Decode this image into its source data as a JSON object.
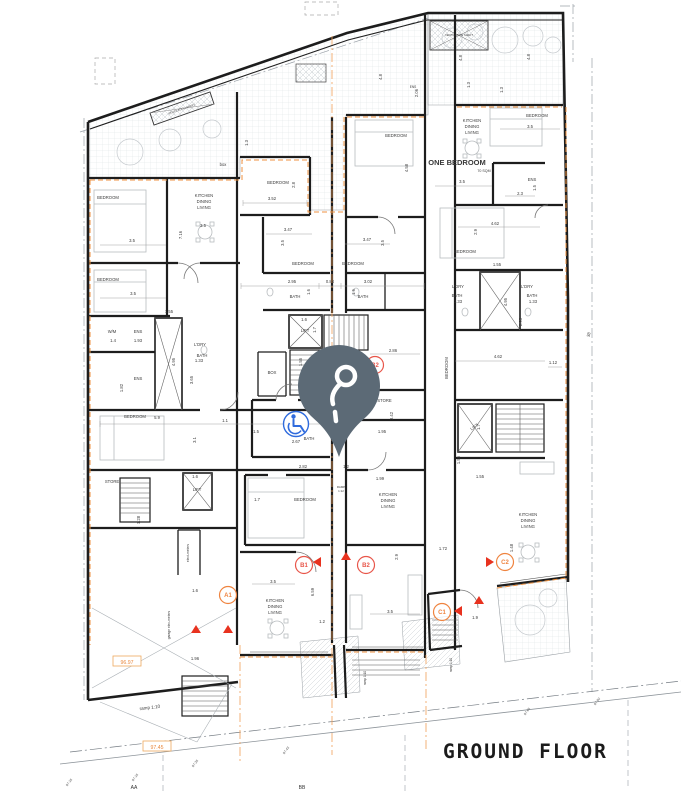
{
  "title": "GROUND FLOOR",
  "colors": {
    "wall": "#1d1d1d",
    "boundary_orange": "#ef9240",
    "marker_red": "#e8564a",
    "marker_orange": "#ef8440",
    "pin": "#5c6a76",
    "accessible_blue": "#2f6bdd",
    "level_orange": "#e8873c",
    "hatch_grey": "#d8dcdf"
  },
  "icons": {
    "pin": "location-pin",
    "accessibility": "wheelchair-symbol"
  },
  "plan": {
    "labels": [
      {
        "n": "room-label",
        "t": "BEDROOM",
        "x": 108,
        "y": 199
      },
      {
        "n": "room-label",
        "t": "BEDROOM",
        "x": 108,
        "y": 281
      },
      {
        "n": "room-label",
        "t": "BEDROOM",
        "x": 278,
        "y": 184
      },
      {
        "n": "room-label",
        "t": "BEDROOM",
        "x": 303,
        "y": 265
      },
      {
        "n": "room-label",
        "t": "BEDROOM",
        "x": 353,
        "y": 265
      },
      {
        "n": "room-label",
        "t": "BEDROOM",
        "x": 396,
        "y": 137
      },
      {
        "n": "room-label",
        "t": "BEDROOM",
        "x": 537,
        "y": 117
      },
      {
        "n": "room-label",
        "t": "BEDROOM",
        "x": 465,
        "y": 253
      },
      {
        "n": "room-label",
        "t": "BEDROOM",
        "x": 135,
        "y": 418
      },
      {
        "n": "room-label",
        "t": "BEDROOM",
        "x": 305,
        "y": 501
      },
      {
        "n": "room-label",
        "t": "BEDROOM",
        "x": 448,
        "y": 368,
        "r": -90
      },
      {
        "n": "room-label",
        "t": "KITCHEN",
        "x": 204,
        "y": 197
      },
      {
        "n": "room-label",
        "t": "DINING",
        "x": 204,
        "y": 203
      },
      {
        "n": "room-label",
        "t": "LIVING",
        "x": 204,
        "y": 209
      },
      {
        "n": "room-label",
        "t": "KITCHEN",
        "x": 472,
        "y": 122
      },
      {
        "n": "room-label",
        "t": "DINING",
        "x": 472,
        "y": 128
      },
      {
        "n": "room-label",
        "t": "LIVING",
        "x": 472,
        "y": 134
      },
      {
        "n": "room-label",
        "t": "KITCHEN",
        "x": 388,
        "y": 496
      },
      {
        "n": "room-label",
        "t": "DINING",
        "x": 388,
        "y": 502
      },
      {
        "n": "room-label",
        "t": "LIVING",
        "x": 388,
        "y": 508
      },
      {
        "n": "room-label",
        "t": "KITCHEN",
        "x": 275,
        "y": 602
      },
      {
        "n": "room-label",
        "t": "DINING",
        "x": 275,
        "y": 608
      },
      {
        "n": "room-label",
        "t": "LIVING",
        "x": 275,
        "y": 614
      },
      {
        "n": "room-label",
        "t": "KITCHEN",
        "x": 528,
        "y": 516
      },
      {
        "n": "room-label",
        "t": "DINING",
        "x": 528,
        "y": 522
      },
      {
        "n": "room-label",
        "t": "LIVING",
        "x": 528,
        "y": 528
      },
      {
        "n": "unit-type-label",
        "t": "ONE BEDROOM",
        "x": 457,
        "y": 165,
        "s": 7.5,
        "b": 1
      },
      {
        "n": "area-label",
        "t": "70 SQM",
        "x": 484,
        "y": 172,
        "s": 3.6
      },
      {
        "n": "room-label",
        "t": "BATH",
        "x": 295,
        "y": 298
      },
      {
        "n": "room-label",
        "t": "BATH",
        "x": 363,
        "y": 298
      },
      {
        "n": "room-label",
        "t": "BATH",
        "x": 202,
        "y": 357
      },
      {
        "n": "room-label",
        "t": "BATH",
        "x": 309,
        "y": 440
      },
      {
        "n": "room-label",
        "t": "BATH",
        "x": 457,
        "y": 297
      },
      {
        "n": "room-label",
        "t": "BATH",
        "x": 532,
        "y": 297
      },
      {
        "n": "room-label",
        "t": "L'DRY",
        "x": 200,
        "y": 346
      },
      {
        "n": "room-label",
        "t": "L'DRY",
        "x": 458,
        "y": 288
      },
      {
        "n": "room-label",
        "t": "L'DRY",
        "x": 527,
        "y": 288
      },
      {
        "n": "room-label",
        "t": "L'DRY/STORE",
        "x": 378,
        "y": 402
      },
      {
        "n": "room-label",
        "t": "ENS",
        "x": 532,
        "y": 181
      },
      {
        "n": "room-label",
        "t": "ENS",
        "x": 413,
        "y": 88,
        "s": 3.2
      },
      {
        "n": "room-label",
        "t": "ENS",
        "x": 138,
        "y": 333
      },
      {
        "n": "room-label",
        "t": "ENS",
        "x": 138,
        "y": 380
      },
      {
        "n": "room-label",
        "t": "W/M",
        "x": 112,
        "y": 333
      },
      {
        "n": "room-label",
        "t": "STORE",
        "x": 112,
        "y": 483
      },
      {
        "n": "room-label",
        "t": "BOX",
        "x": 272,
        "y": 374
      },
      {
        "n": "room-label",
        "t": "box",
        "x": 223,
        "y": 166
      },
      {
        "n": "room-label",
        "t": "LIFT",
        "x": 305,
        "y": 332
      },
      {
        "n": "room-label",
        "t": "LIFT",
        "x": 197,
        "y": 491
      },
      {
        "n": "room-label",
        "t": "LIFT",
        "x": 475,
        "y": 428,
        "r": -35
      },
      {
        "n": "shaft-label",
        "t": "VENTILATION SHAFT",
        "x": 182,
        "y": 110,
        "s": 2.8,
        "r": -19
      },
      {
        "n": "shaft-label",
        "t": "VENTILATION SHAFT",
        "x": 459,
        "y": 36,
        "s": 2.8
      },
      {
        "n": "note-label",
        "t": "ramp 1:10",
        "x": 150,
        "y": 709,
        "s": 4.6,
        "r": -7
      },
      {
        "n": "note-label",
        "t": "RAMP",
        "x": 341,
        "y": 488,
        "s": 2.9
      },
      {
        "n": "note-label",
        "t": "1:12",
        "x": 341,
        "y": 492,
        "s": 2.9
      },
      {
        "n": "note-label",
        "t": "ramp 1:10",
        "x": 366,
        "y": 678,
        "s": 3.2,
        "r": -90
      },
      {
        "n": "note-label",
        "t": "ramp 1:10",
        "x": 452,
        "y": 665,
        "s": 3.2,
        "r": -90
      },
      {
        "n": "note-label",
        "t": "elect-meters",
        "x": 189,
        "y": 553,
        "s": 3.3,
        "r": -90
      },
      {
        "n": "note-label",
        "t": "garage elec-meters",
        "x": 170,
        "y": 625,
        "s": 3.3,
        "r": -90
      },
      {
        "n": "dim-label",
        "t": "3.52",
        "x": 272,
        "y": 200
      },
      {
        "n": "dim-label",
        "t": "3.47",
        "x": 288,
        "y": 231
      },
      {
        "n": "dim-label",
        "t": "3.47",
        "x": 367,
        "y": 241
      },
      {
        "n": "dim-label",
        "t": "3.5",
        "x": 284,
        "y": 243,
        "r": -90
      },
      {
        "n": "dim-label",
        "t": "3.5",
        "x": 384,
        "y": 243,
        "r": -90
      },
      {
        "n": "dim-label",
        "t": "2.8",
        "x": 295,
        "y": 185,
        "r": -90
      },
      {
        "n": "dim-label",
        "t": "4.58",
        "x": 408,
        "y": 168,
        "r": -90
      },
      {
        "n": "dim-label",
        "t": "1.3",
        "x": 248,
        "y": 143,
        "r": -90
      },
      {
        "n": "dim-label",
        "t": "4.8",
        "x": 382,
        "y": 77,
        "r": -90
      },
      {
        "n": "dim-label",
        "t": "4.8",
        "x": 462,
        "y": 58,
        "r": -90
      },
      {
        "n": "dim-label",
        "t": "4.8",
        "x": 530,
        "y": 57,
        "r": -90
      },
      {
        "n": "dim-label",
        "t": "2.06",
        "x": 418,
        "y": 93,
        "r": -90
      },
      {
        "n": "dim-label",
        "t": "1.3",
        "x": 470,
        "y": 85,
        "r": -90
      },
      {
        "n": "dim-label",
        "t": "1.3",
        "x": 503,
        "y": 90,
        "r": -90
      },
      {
        "n": "dim-label",
        "t": "3.5",
        "x": 132,
        "y": 242
      },
      {
        "n": "dim-label",
        "t": "3.5",
        "x": 133,
        "y": 295
      },
      {
        "n": "dim-label",
        "t": "3.5",
        "x": 203,
        "y": 227
      },
      {
        "n": "dim-label",
        "t": "7.16",
        "x": 182,
        "y": 235,
        "r": -90
      },
      {
        "n": "dim-label",
        "t": "2.95",
        "x": 292,
        "y": 283
      },
      {
        "n": "dim-label",
        "t": "0.84",
        "x": 330,
        "y": 283
      },
      {
        "n": "dim-label",
        "t": "3.02",
        "x": 368,
        "y": 283
      },
      {
        "n": "dim-label",
        "t": "1.6",
        "x": 310,
        "y": 292,
        "r": -90
      },
      {
        "n": "dim-label",
        "t": "1.6",
        "x": 355,
        "y": 292,
        "r": -90
      },
      {
        "n": "dim-label",
        "t": "1.6",
        "x": 304,
        "y": 321
      },
      {
        "n": "dim-label",
        "t": "1.7",
        "x": 316,
        "y": 330,
        "r": -90
      },
      {
        "n": "dim-label",
        "t": "2.86",
        "x": 393,
        "y": 352
      },
      {
        "n": "dim-label",
        "t": "1.55",
        "x": 302,
        "y": 362,
        "r": -90
      },
      {
        "n": "dim-label",
        "t": "3.5",
        "x": 462,
        "y": 183
      },
      {
        "n": "dim-label",
        "t": "3.5",
        "x": 530,
        "y": 128
      },
      {
        "n": "dim-label",
        "t": "2.3",
        "x": 520,
        "y": 195
      },
      {
        "n": "dim-label",
        "t": "1.5",
        "x": 536,
        "y": 188,
        "r": -90
      },
      {
        "n": "dim-label",
        "t": "4.62",
        "x": 495,
        "y": 225
      },
      {
        "n": "dim-label",
        "t": "2.9",
        "x": 477,
        "y": 232,
        "r": -90
      },
      {
        "n": "dim-label",
        "t": "1.55",
        "x": 497,
        "y": 266
      },
      {
        "n": "dim-label",
        "t": "4.95",
        "x": 507,
        "y": 302,
        "r": -90
      },
      {
        "n": "dim-label",
        "t": "1.33",
        "x": 458,
        "y": 303
      },
      {
        "n": "dim-label",
        "t": "1.33",
        "x": 533,
        "y": 303
      },
      {
        "n": "dim-label",
        "t": "2.95",
        "x": 522,
        "y": 322,
        "r": -90
      },
      {
        "n": "dim-label",
        "t": "4.62",
        "x": 498,
        "y": 358
      },
      {
        "n": "dim-label",
        "t": "1.12",
        "x": 553,
        "y": 364
      },
      {
        "n": "dim-label",
        "t": "38",
        "x": 590,
        "y": 335,
        "r": -75
      },
      {
        "n": "dim-label",
        "t": "1.55",
        "x": 169,
        "y": 313
      },
      {
        "n": "dim-label",
        "t": "4.95",
        "x": 175,
        "y": 362,
        "r": -90
      },
      {
        "n": "dim-label",
        "t": "1.4",
        "x": 113,
        "y": 342
      },
      {
        "n": "dim-label",
        "t": "1.93",
        "x": 138,
        "y": 342
      },
      {
        "n": "dim-label",
        "t": "1.82",
        "x": 123,
        "y": 388,
        "r": -90
      },
      {
        "n": "dim-label",
        "t": "3.65",
        "x": 193,
        "y": 380,
        "r": -90
      },
      {
        "n": "dim-label",
        "t": "1.33",
        "x": 199,
        "y": 362
      },
      {
        "n": "dim-label",
        "t": "5.9",
        "x": 157,
        "y": 419
      },
      {
        "n": "dim-label",
        "t": "1.1",
        "x": 225,
        "y": 422
      },
      {
        "n": "dim-label",
        "t": "3.1",
        "x": 196,
        "y": 440,
        "r": -90
      },
      {
        "n": "dim-label",
        "t": "2.67",
        "x": 296,
        "y": 443
      },
      {
        "n": "dim-label",
        "t": "1.5",
        "x": 256,
        "y": 433
      },
      {
        "n": "dim-label",
        "t": "2.82",
        "x": 303,
        "y": 468
      },
      {
        "n": "dim-label",
        "t": "1.2",
        "x": 346,
        "y": 468
      },
      {
        "n": "dim-label",
        "t": "1.7",
        "x": 257,
        "y": 501
      },
      {
        "n": "dim-label",
        "t": "3.5",
        "x": 273,
        "y": 583
      },
      {
        "n": "dim-label",
        "t": "6.59",
        "x": 314,
        "y": 592,
        "r": -90
      },
      {
        "n": "dim-label",
        "t": "1.2",
        "x": 322,
        "y": 623
      },
      {
        "n": "dim-label",
        "t": "1.95",
        "x": 382,
        "y": 433
      },
      {
        "n": "dim-label",
        "t": "3.42",
        "x": 393,
        "y": 416,
        "r": -90
      },
      {
        "n": "dim-label",
        "t": "1.99",
        "x": 380,
        "y": 480
      },
      {
        "n": "dim-label",
        "t": "3.5",
        "x": 390,
        "y": 613
      },
      {
        "n": "dim-label",
        "t": "2.9",
        "x": 398,
        "y": 557,
        "r": -90
      },
      {
        "n": "dim-label",
        "t": "1.9",
        "x": 475,
        "y": 619
      },
      {
        "n": "dim-label",
        "t": "1.7",
        "x": 480,
        "y": 427,
        "r": -90
      },
      {
        "n": "dim-label",
        "t": "1.55",
        "x": 460,
        "y": 460,
        "r": -90
      },
      {
        "n": "dim-label",
        "t": "1.55",
        "x": 480,
        "y": 478
      },
      {
        "n": "dim-label",
        "t": "1.72",
        "x": 443,
        "y": 550
      },
      {
        "n": "dim-label",
        "t": "1.48",
        "x": 513,
        "y": 548,
        "r": -90
      },
      {
        "n": "dim-label",
        "t": "1.96",
        "x": 195,
        "y": 660
      },
      {
        "n": "dim-label",
        "t": "1.6",
        "x": 195,
        "y": 592
      },
      {
        "n": "dim-label",
        "t": "1.6",
        "x": 195,
        "y": 478
      },
      {
        "n": "dim-label",
        "t": "1.28",
        "x": 140,
        "y": 520,
        "r": -90
      }
    ],
    "markers": [
      {
        "id": "A1",
        "x": 228,
        "y": 595,
        "c": "#ef8440"
      },
      {
        "id": "B1",
        "x": 304,
        "y": 565,
        "c": "#e8564a"
      },
      {
        "id": "B2",
        "x": 366,
        "y": 565,
        "c": "#e8564a"
      },
      {
        "id": "B2",
        "x": 375,
        "y": 365,
        "c": "#e8564a"
      },
      {
        "id": "C1",
        "x": 442,
        "y": 612,
        "c": "#ef8440"
      },
      {
        "id": "C2",
        "x": 505,
        "y": 562,
        "c": "#ef8440"
      }
    ],
    "arrows": [
      {
        "x": 361,
        "y": 366,
        "d": "R"
      },
      {
        "x": 317,
        "y": 562,
        "d": "L"
      },
      {
        "x": 346,
        "y": 556,
        "d": "U"
      },
      {
        "x": 196,
        "y": 629,
        "d": "U"
      },
      {
        "x": 228,
        "y": 629,
        "d": "U"
      },
      {
        "x": 458,
        "y": 611,
        "d": "L"
      },
      {
        "x": 479,
        "y": 600,
        "d": "U"
      },
      {
        "x": 490,
        "y": 562,
        "d": "R"
      }
    ],
    "levels": [
      {
        "v": "96.97",
        "x": 127,
        "y": 662
      },
      {
        "v": "97.45",
        "x": 157,
        "y": 747
      }
    ],
    "spot_levels": [
      {
        "v": "97.16",
        "x": 70,
        "y": 783
      },
      {
        "v": "97.16",
        "x": 136,
        "y": 778
      },
      {
        "v": "97.26",
        "x": 196,
        "y": 764
      },
      {
        "v": "97.43",
        "x": 287,
        "y": 751
      },
      {
        "v": "97.65",
        "x": 528,
        "y": 712
      },
      {
        "v": "97.80",
        "x": 598,
        "y": 702
      }
    ],
    "sections": [
      {
        "v": "AA",
        "x": 134,
        "y": 789
      },
      {
        "v": "BB",
        "x": 302,
        "y": 789
      }
    ]
  }
}
